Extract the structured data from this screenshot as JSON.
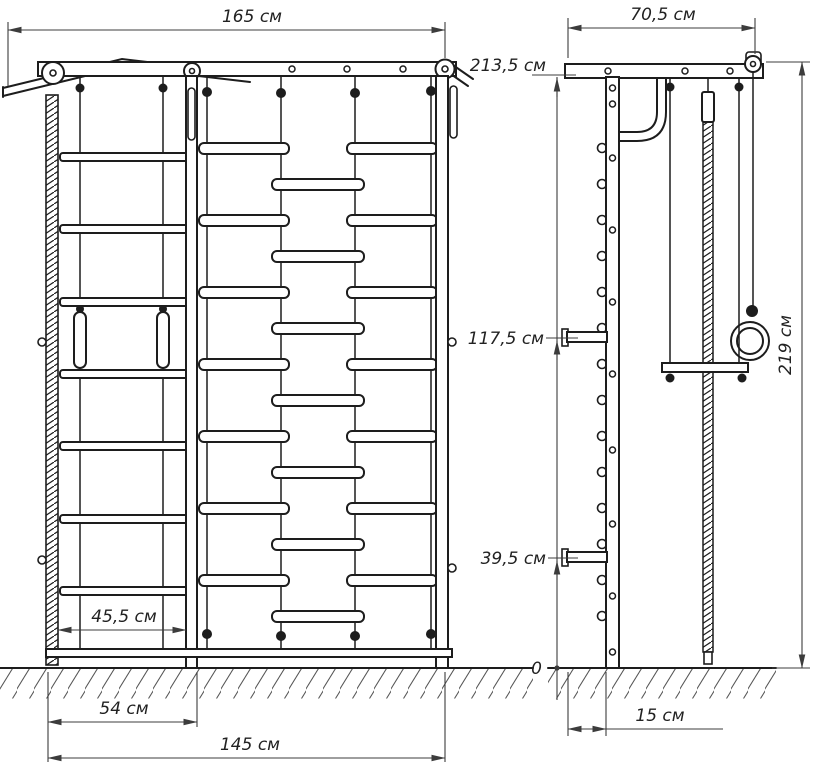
{
  "drawing": {
    "kind": "technical dimension drawing — wall bars / gymnastics ladder, front and side views",
    "colors": {
      "line": "#1d1d1d",
      "dimension": "#3c3c3c",
      "background": "#ffffff"
    },
    "dim": {
      "front_width": "165 см",
      "side_width": "70,5 см",
      "height_upper": "213,5 см",
      "height_middle": "117,5 см",
      "height_lower": "39,5 см",
      "ground": "0",
      "total_height": "219 см",
      "inner_width": "45,5 см",
      "ladder_width": "54 см",
      "base_width": "145 см",
      "depth": "15 см"
    }
  }
}
